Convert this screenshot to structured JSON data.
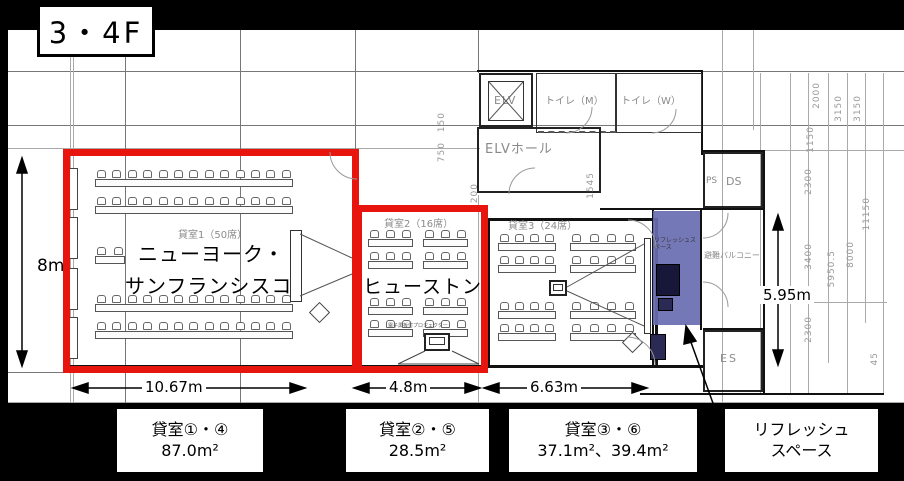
{
  "floor_label": "3・4F",
  "plan": {
    "elv": "ELV",
    "elv_hall": "ELVホール",
    "toilet_m": "トイレ（M）",
    "toilet_w": "トイレ（W）",
    "ps": "PS",
    "ds": "DS",
    "balcony": "避難バルコニー",
    "es": "ES",
    "room1_label": "貸室1（50席）",
    "room2_label": "貸室2（16席）",
    "room3_label": "貸室3（24席）",
    "room1_name_line1": "ニューヨーク・",
    "room1_name_line2": "サンフランシスコ",
    "room2_name": "ヒューストン",
    "refresh_label": "リフレッシュスペース",
    "projector_note": "電子黒板付プロジェクター"
  },
  "dimensions": {
    "height_left": "8m",
    "width_room1": "10.67m",
    "width_room2": "4.8m",
    "width_room3": "6.63m",
    "height_balcony": "5.95m",
    "grid_dims": [
      "1150",
      "2000",
      "3150",
      "3150",
      "2300",
      "3400",
      "5950.5",
      "8000",
      "11150",
      "2300",
      "45",
      "750",
      "150",
      "1200",
      "1545"
    ]
  },
  "legend": [
    {
      "line1": "貸室①・④",
      "line2": "87.0m²"
    },
    {
      "line1": "貸室②・⑤",
      "line2": "28.5m²"
    },
    {
      "line1": "貸室③・⑥",
      "line2": "37.1m²、39.4m²"
    },
    {
      "line1": "リフレッシュ",
      "line2": "スペース"
    }
  ],
  "colors": {
    "highlight_red": "#e8150f",
    "refresh_purple": "#686cb0"
  }
}
